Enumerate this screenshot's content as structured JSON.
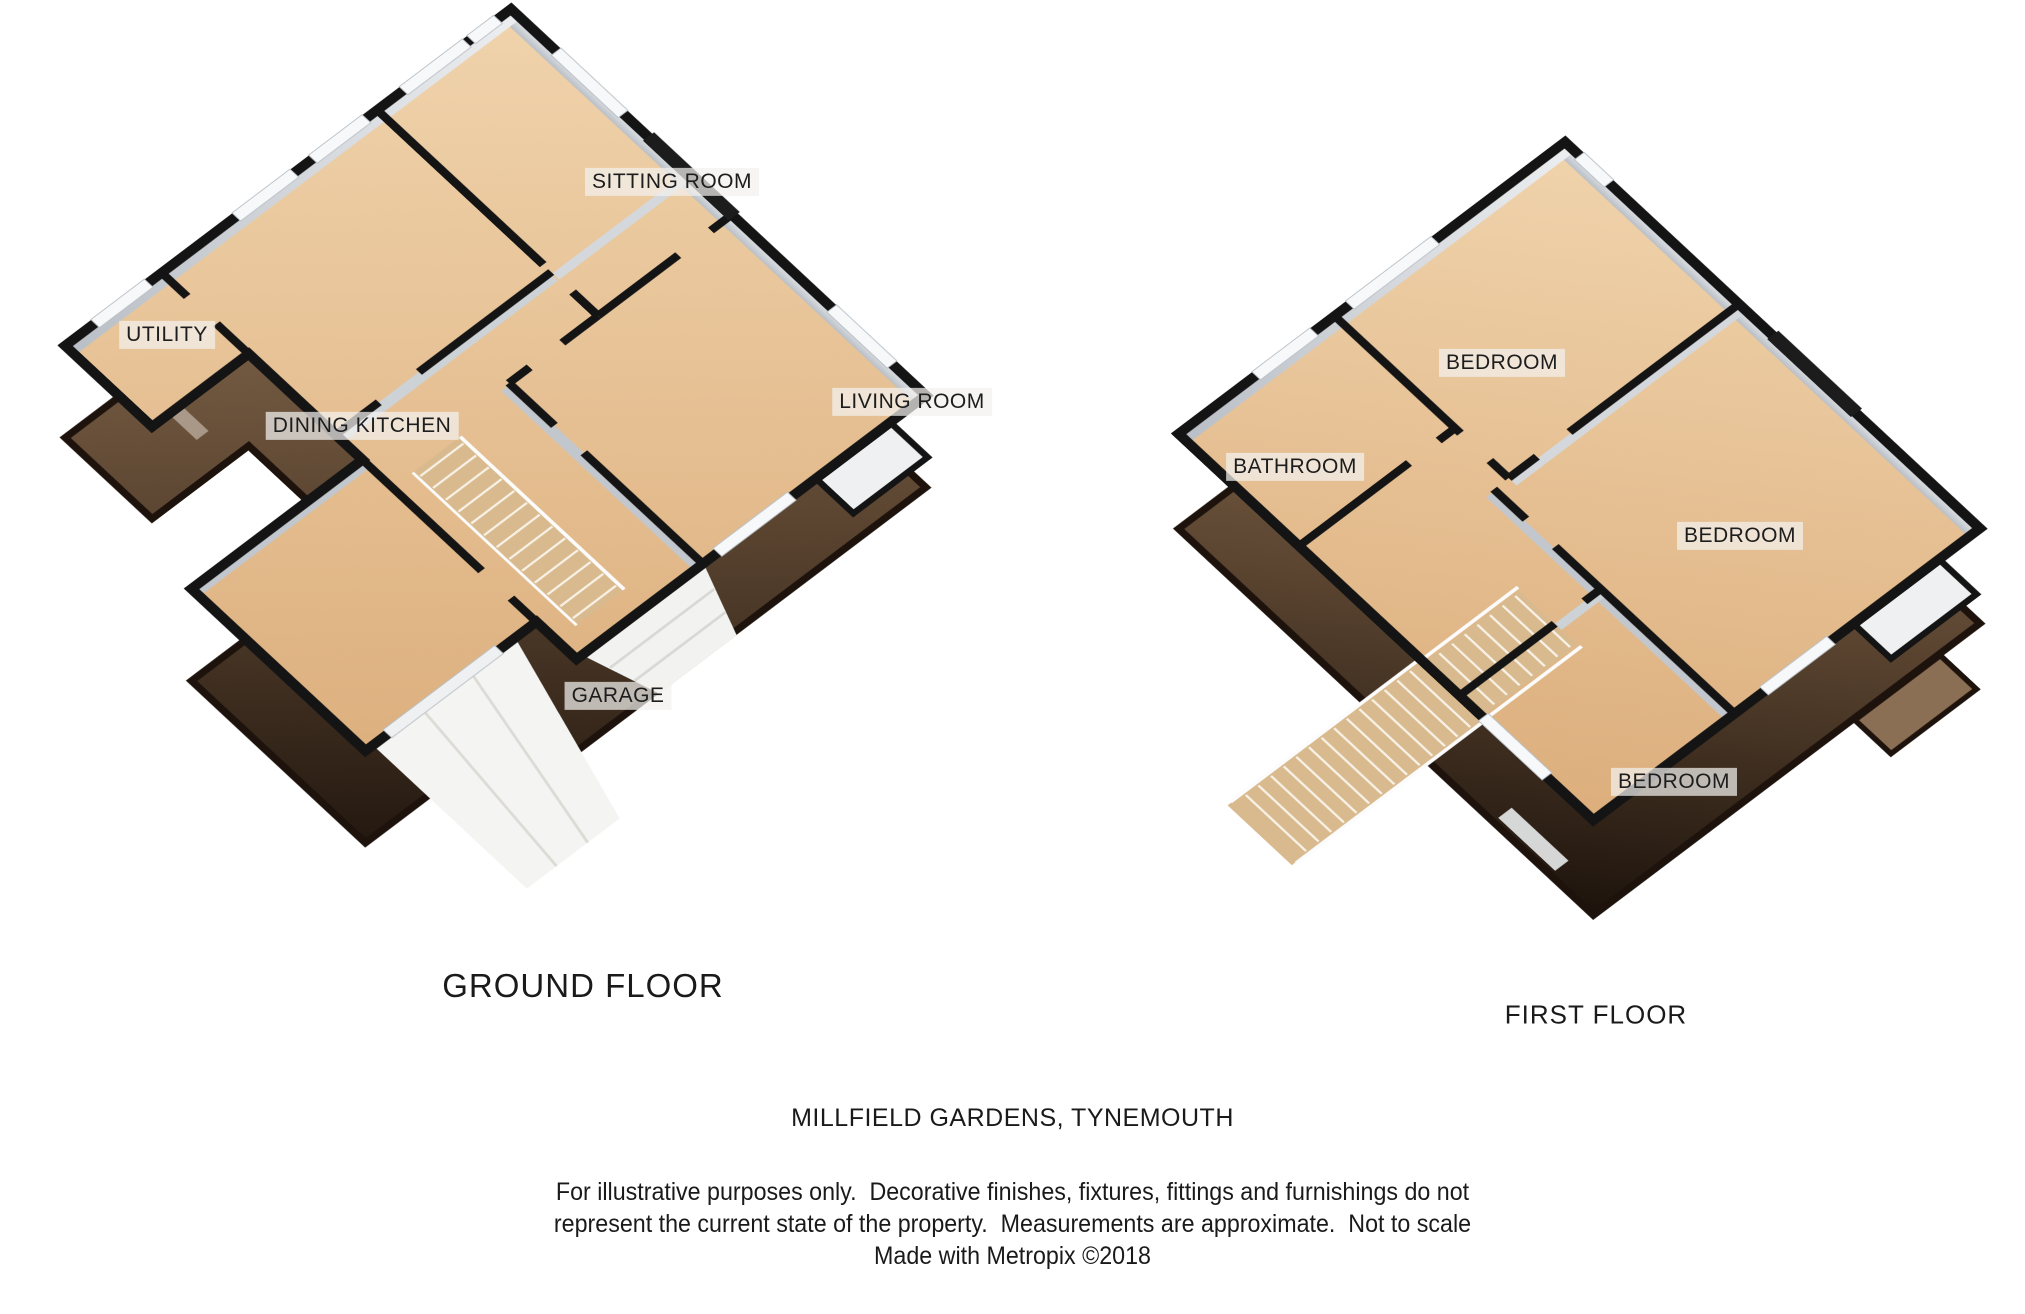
{
  "ground_floor": {
    "caption": "GROUND FLOOR",
    "rooms": {
      "sitting": "SITTING ROOM",
      "utility": "UTILITY",
      "dining_kitchen": "DINING KITCHEN",
      "living": "LIVING ROOM",
      "garage": "GARAGE"
    }
  },
  "first_floor": {
    "caption": "FIRST FLOOR",
    "rooms": {
      "bedroom_top": "BEDROOM",
      "bathroom": "BATHROOM",
      "bedroom_right": "BEDROOM",
      "bedroom_bottom": "BEDROOM"
    }
  },
  "footer": {
    "address": "MILLFIELD GARDENS, TYNEMOUTH",
    "disclaimer_line1": "For illustrative purposes only.  Decorative finishes, fixtures, fittings and furnishings do not",
    "disclaimer_line2": "represent the current state of the property.  Measurements are approximate.  Not to scale",
    "credit": "Made with Metropix ©2018"
  },
  "colors": {
    "floor_light": "#f0d3ac",
    "floor_dark": "#dcae7c",
    "wall_line": "#141414",
    "wall_outer_light": "#96775a",
    "wall_outer_dark": "#1d130c",
    "wall_inner_gray": "#c2c7cd",
    "window_white": "#f6f8fa",
    "dark_feature": "#1c1c1c",
    "stair_wood": "#d9ba8e",
    "paving_white": "#f4f4f2"
  }
}
